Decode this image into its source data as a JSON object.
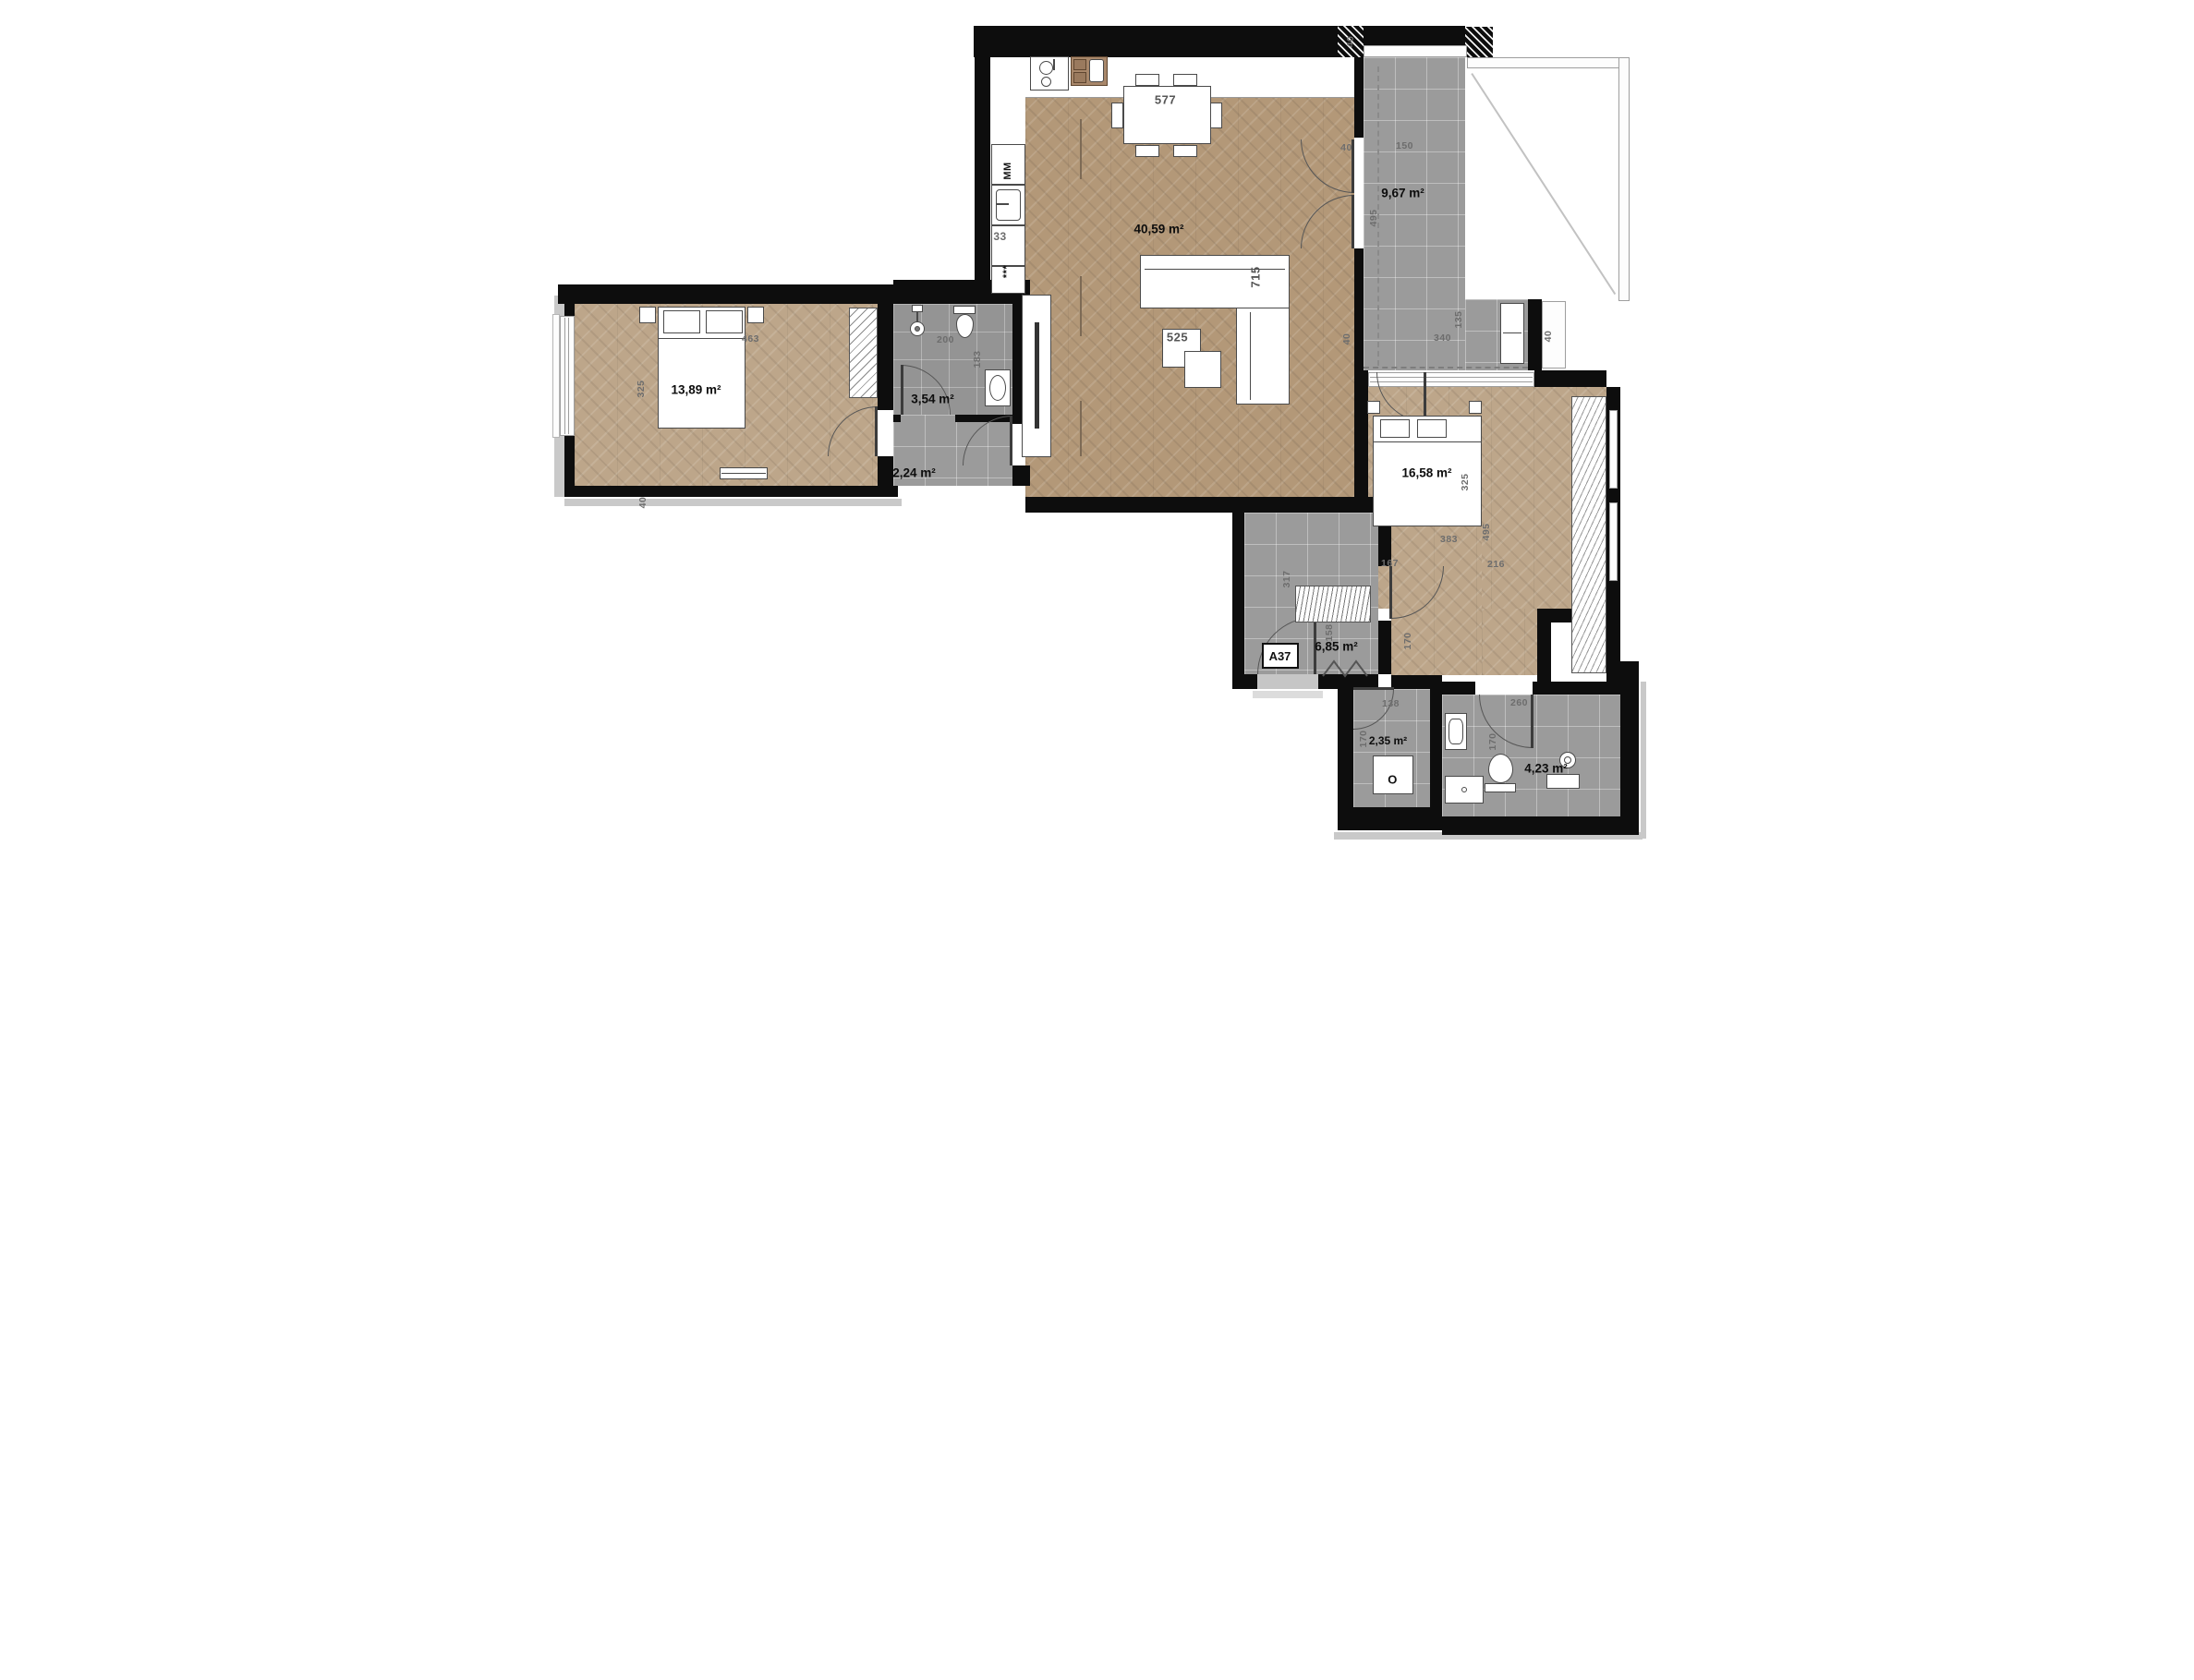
{
  "plan": {
    "unit": "A37",
    "areas": {
      "bedroom1": "13,89 m²",
      "bathroom1": "3,54 m²",
      "hallway": "2,24 m²",
      "living": "40,59 m²",
      "terrace": "9,67 m²",
      "bedroom2": "16,58 m²",
      "corridor": "6,85 m²",
      "storage": "2,35 m²",
      "bathroom2": "4,23 m²"
    },
    "furniture": {
      "dining_table": "577",
      "sofa": "715",
      "coffee_table": "525"
    },
    "appliances": {
      "washing_machine": "MM",
      "stars": "***",
      "cabinet": "33",
      "boiler": "O"
    },
    "dims": {
      "33": "33",
      "40": "40",
      "135": "135",
      "138": "138",
      "150": "150",
      "158": "158",
      "167": "167",
      "170": "170",
      "183": "183",
      "200": "200",
      "216": "216",
      "260": "260",
      "317": "317",
      "325": "325",
      "340": "340",
      "383": "383",
      "463": "463",
      "495": "495"
    },
    "colors": {
      "wall": "#0d0d0d",
      "parquet": "#b39878",
      "tile": "#9b9b9b",
      "wood": "#a8876a"
    }
  }
}
